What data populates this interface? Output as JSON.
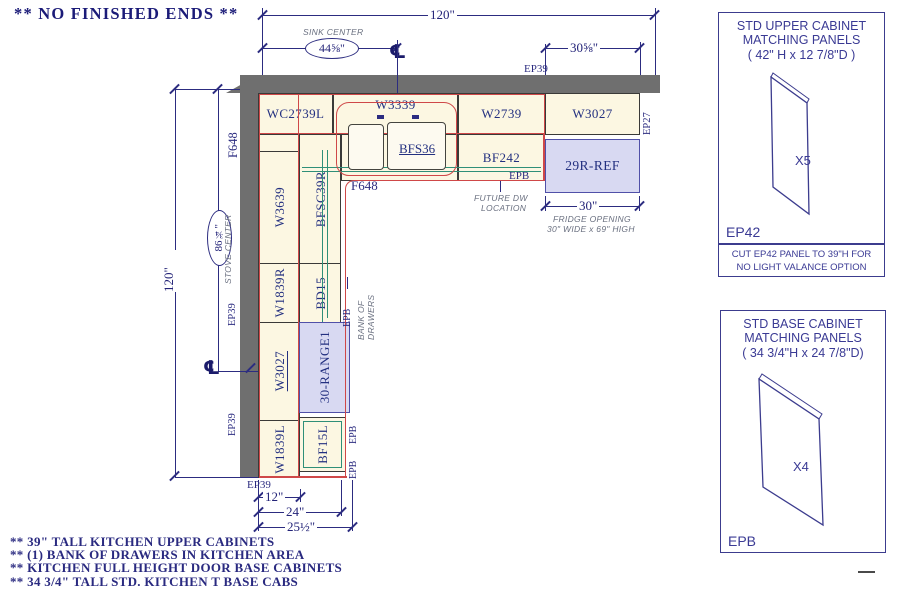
{
  "title": "** NO FINISHED ENDS **",
  "cabinets": {
    "wc2739l": "WC2739L",
    "w3339": "W3339",
    "w2739": "W2739",
    "w3027_top": "W3027",
    "bfs36": "BFS36",
    "bf242": "BF242",
    "fridge": "29R-REF",
    "w3639": "W3639",
    "bfsc39r": "BFSC39R",
    "w1839r": "W1839R",
    "bd15": "BD15",
    "w3027_left": "W3027",
    "range": "30-RANGE1",
    "w1839l": "W1839L",
    "bf15l": "BF15L",
    "f648_wall": "F648",
    "f648_corner": "F648"
  },
  "edge_labels": {
    "ep39_top": "EP39",
    "ep27": "EP27",
    "ep39_left_upper": "EP39",
    "ep39_left_lower": "EP39",
    "ep39_bottom": "EP39",
    "epb_fridge": "EPB",
    "epb_corner": "EPB",
    "epb_range": "EPB",
    "epb_bf15l": "EPB"
  },
  "dimensions": {
    "top_overall": "120\"",
    "sink_center": "44⅝\"",
    "upper_right": "30⅝\"",
    "left_overall": "120\"",
    "stove_center": "86¾\"",
    "bottom_12": "12\"",
    "bottom_24": "24\"",
    "bottom_25": "25½\"",
    "fridge_opening": "30\""
  },
  "annotations": {
    "sink_center": "SINK CENTER",
    "stove_center": "STOVE CENTER",
    "future_dw_line1": "FUTURE DW",
    "future_dw_line2": "LOCATION",
    "fridge_line1": "FRIDGE OPENING",
    "fridge_line2": "30\" WIDE x 69\" HIGH",
    "bank_line1": "BANK OF",
    "bank_line2": "DRAWERS",
    "centerline": "℄"
  },
  "panels": {
    "upper": {
      "title1": "STD UPPER CABINET",
      "title2": "MATCHING PANELS",
      "title3": "( 42\" H x 12 7/8\"D )",
      "qty": "X5",
      "code": "EP42",
      "note1": "CUT EP42 PANEL TO 39\"H FOR",
      "note2": "NO LIGHT VALANCE OPTION"
    },
    "base": {
      "title1": "STD BASE CABINET",
      "title2": "MATCHING PANELS",
      "title3": "( 34 3/4\"H x 24 7/8\"D)",
      "qty": "X4",
      "code": "EPB"
    }
  },
  "notes": [
    "** 39\" TALL KITCHEN UPPER CABINETS",
    "** (1) BANK OF DRAWERS IN KITCHEN AREA",
    "** KITCHEN FULL HEIGHT DOOR BASE CABINETS",
    "** 34 3/4\" TALL STD. KITCHEN T BASE CABS"
  ]
}
